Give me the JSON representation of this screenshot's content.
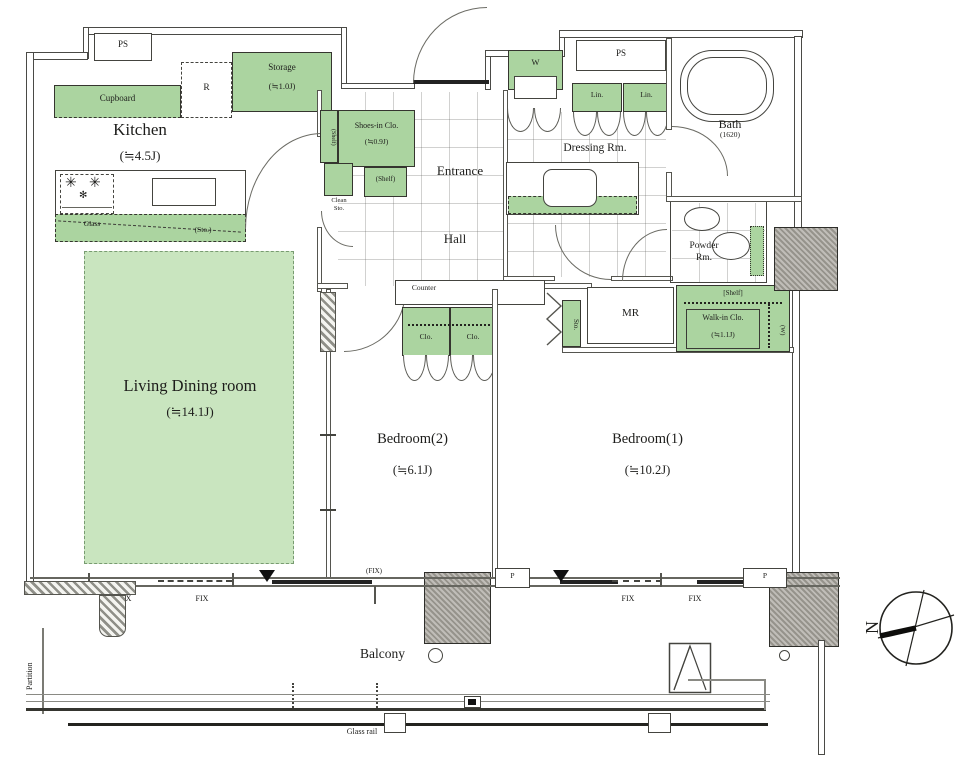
{
  "colors": {
    "green": "#abd4a0",
    "green-light": "#c9e5bf",
    "pillar": "#a7a49c",
    "line": "#4a4a46",
    "text": "#1d1d1b"
  },
  "rooms": {
    "kitchen": {
      "name": "Kitchen",
      "area": "(≒4.5J)"
    },
    "living": {
      "name": "Living Dining room",
      "area": "(≒14.1J)"
    },
    "bedroom2": {
      "name": "Bedroom(2)",
      "area": "(≒6.1J)"
    },
    "bedroom1": {
      "name": "Bedroom(1)",
      "area": "(≒10.2J)"
    },
    "entrance": "Entrance",
    "hall": "Hall",
    "dressing": "Dressing Rm.",
    "bath": {
      "name": "Bath",
      "size": "(1620)"
    },
    "powder": {
      "line1": "Powder",
      "line2": "Rm."
    },
    "balcony": "Balcony",
    "mr": "MR"
  },
  "storage": {
    "cupboard": "Cupboard",
    "storage": {
      "name": "Storage",
      "area": "(≒1.0J)"
    },
    "shoes": {
      "name": "Shoes-in Clo.",
      "area": "(≒0.9J)"
    },
    "shelf": "(Shelf)",
    "shelf_bracket": "[Shelf]",
    "clean_sto": {
      "line1": "Clean",
      "line2": "Sto."
    },
    "walkin": {
      "name": "Walk-in Clo.",
      "area": "(≒1.1J)",
      "w": "(W)"
    },
    "clo": "Clo.",
    "lin": "Lin.",
    "sto": "Sto.",
    "washer": "W",
    "fridge": "R",
    "glass": "Glass",
    "sto_paren": "(Sto.)"
  },
  "labels": {
    "ps": "PS",
    "counter": "Counter",
    "fix": "FIX",
    "fix_paren": "(FIX)",
    "p": "P",
    "glass_rail": "Glass rail",
    "partition": "Partition",
    "north": "N"
  },
  "icons": {
    "burner": "✳",
    "burner_small": "✻"
  }
}
